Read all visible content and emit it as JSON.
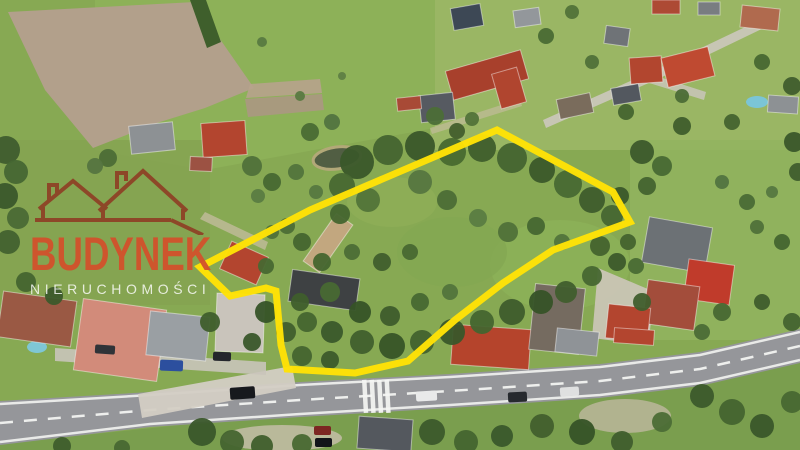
{
  "meta": {
    "type": "aerial-drone-photo",
    "width": 800,
    "height": 450,
    "description": "Aerial drone photo of a rural village property: an irregular wooded land parcel outlined in bright yellow, surrounded by houses, barns, fields, and a main road with a pedestrian crosswalk along the bottom. Real-estate agency watermark on the left."
  },
  "watermark": {
    "brand": "BUDYNEK",
    "subtitle": "NIERUCHOMOŚCI",
    "brand_color": "#d2512c",
    "subtitle_color": "#ffffff",
    "icon": "rooflines-icon",
    "icon_color": "#8f3722"
  },
  "parcel": {
    "outline_color": "#ffe206",
    "outline_width": 7,
    "outline_points": "497,130 613,192 630,222 553,250 503,283 455,320 408,361 355,373 287,369 281,345 276,291 266,288 230,296 200,267 310,210"
  },
  "scene": {
    "base": {
      "fill": "#87a953"
    },
    "regions": [
      {
        "name": "village-ground",
        "type": "rect",
        "x": 430,
        "y": 0,
        "w": 370,
        "h": 150,
        "fill": "#9cb766",
        "opacity": 0.9
      },
      {
        "name": "meadow-top",
        "type": "poly",
        "pts": "95,0 435,0 435,128 205,170 95,150",
        "fill": "#8db158",
        "opacity": 0.95
      },
      {
        "name": "lawn-left",
        "type": "rect",
        "x": 0,
        "y": 140,
        "w": 210,
        "h": 165,
        "fill": "#84a251",
        "opacity": 0.8
      },
      {
        "name": "plowed-field",
        "type": "poly",
        "pts": "8,12 195,2 222,42 254,88 205,108 160,122 93,148 45,90",
        "fill": "#b2a08b",
        "opacity": 1
      },
      {
        "name": "field-strip-1",
        "type": "poly",
        "pts": "245,99 322,94 324,110 248,117",
        "fill": "#ab9883",
        "opacity": 0.9
      },
      {
        "name": "field-strip-2",
        "type": "poly",
        "pts": "250,84 320,79 322,93 246,98",
        "fill": "#b7a38d",
        "opacity": 0.9
      },
      {
        "name": "right-field",
        "type": "rect",
        "x": 630,
        "y": 140,
        "w": 170,
        "h": 200,
        "fill": "#92b45f",
        "opacity": 0.85
      },
      {
        "name": "bottom-verge",
        "type": "poly",
        "pts": "0,444 800,360 800,450 0,450",
        "fill": "#7a9e4e",
        "opacity": 1
      },
      {
        "name": "parcel-grass-1",
        "type": "ellipse",
        "cx": 560,
        "cy": 265,
        "rx": 70,
        "ry": 45,
        "fill": "#8cb058",
        "opacity": 0.9
      },
      {
        "name": "parcel-grass-2",
        "type": "ellipse",
        "cx": 452,
        "cy": 252,
        "rx": 55,
        "ry": 35,
        "fill": "#84a852",
        "opacity": 0.85
      },
      {
        "name": "parcel-grass-3",
        "type": "ellipse",
        "cx": 392,
        "cy": 202,
        "rx": 45,
        "ry": 25,
        "fill": "#8fae57",
        "opacity": 0.8
      },
      {
        "name": "hedge-top",
        "type": "poly",
        "pts": "190,0 206,0 221,42 207,48",
        "fill": "#3f5f2c",
        "opacity": 1
      }
    ],
    "paths": [
      {
        "name": "driveway-apron",
        "type": "poly",
        "pts": "138,394 292,366 296,388 142,418",
        "fill": "#d3cec4",
        "opacity": 0.95
      },
      {
        "name": "side-street",
        "type": "poly",
        "pts": "55,348 266,362 266,375 55,361",
        "fill": "#c9c4ba",
        "opacity": 0.9
      },
      {
        "name": "gravel-yard",
        "type": "poly",
        "pts": "598,268 655,292 648,345 592,338",
        "fill": "#cdc6ba",
        "opacity": 0.9
      },
      {
        "name": "dirt-patch-1",
        "type": "ellipse",
        "cx": 282,
        "cy": 438,
        "rx": 60,
        "ry": 13,
        "fill": "#c9bfae",
        "opacity": 0.8
      },
      {
        "name": "dirt-patch-2",
        "type": "ellipse",
        "cx": 625,
        "cy": 416,
        "rx": 46,
        "ry": 17,
        "fill": "#c4b9a5",
        "opacity": 0.75
      },
      {
        "name": "village-street",
        "type": "poly",
        "pts": "543,120 655,70 764,18 770,25 660,78 546,128",
        "fill": "#ccc8bd",
        "opacity": 0.9
      },
      {
        "name": "village-street-spur",
        "type": "poly",
        "pts": "650,74 706,92 704,100 646,82",
        "fill": "#c9c5ba",
        "opacity": 0.85
      },
      {
        "name": "farm-track",
        "type": "poly",
        "pts": "430,128 520,99 522,106 432,134",
        "fill": "#c9bda4",
        "opacity": 0.6
      },
      {
        "name": "garden-path",
        "type": "poly",
        "pts": "205,212 268,242 265,250 200,219",
        "fill": "#cbbfa6",
        "opacity": 0.7
      }
    ],
    "pond": {
      "cx": 337,
      "cy": 158,
      "rx": 24,
      "ry": 11,
      "rot": -8,
      "fill": "#4f5a43",
      "stroke": "#b5a87b"
    },
    "pools": [
      {
        "cx": 37,
        "cy": 347,
        "rx": 10,
        "ry": 6,
        "fill": "#7ec8dc"
      },
      {
        "cx": 757,
        "cy": 102,
        "rx": 11,
        "ry": 6,
        "fill": "#79c6dc"
      }
    ],
    "road": {
      "surface": "0,401 150,392 300,382 450,374 600,364 700,352 800,329 800,363 700,386 600,398 450,408 300,417 150,427 0,445",
      "fill": "#95969a",
      "edge_top": "0,404 150,395 300,385 450,377 600,367 700,355 800,332",
      "edge_bottom": "0,442 150,424 300,414 450,405 600,395 700,383 800,360",
      "center": "0,423 150,410 300,400 450,391 600,381 700,369 800,346",
      "line_color": "#f2f3f1",
      "dash": "13 11"
    },
    "crosswalk": {
      "xs": [
        362,
        369.5,
        377,
        384.5
      ],
      "y": 380,
      "w": 4.5,
      "h": 33,
      "rot": -3,
      "fill": "#f4f5f3"
    },
    "buildings": [
      [
        130,
        124,
        44,
        28,
        -6,
        "#8d9194",
        "house-roof"
      ],
      [
        202,
        122,
        44,
        34,
        -4,
        "#b3452f",
        "house-roof-red"
      ],
      [
        190,
        157,
        22,
        14,
        3,
        "#9c5243",
        "shed-roof"
      ],
      [
        452,
        6,
        30,
        22,
        -10,
        "#3d4855",
        "house-roof-dark"
      ],
      [
        514,
        9,
        26,
        17,
        -8,
        "#93979b",
        "house-roof"
      ],
      [
        448,
        60,
        78,
        30,
        -16,
        "#a8402c",
        "barn-roof-red"
      ],
      [
        496,
        70,
        26,
        36,
        -16,
        "#b0452f",
        "barn-wing-roof"
      ],
      [
        420,
        94,
        34,
        27,
        -6,
        "#565a61",
        "house-roof-grey"
      ],
      [
        397,
        97,
        24,
        13,
        -6,
        "#a84a36",
        "shed-roof-red"
      ],
      [
        605,
        27,
        24,
        18,
        8,
        "#6f7377",
        "house-roof"
      ],
      [
        630,
        57,
        32,
        26,
        -4,
        "#b2462f",
        "house-roof-red"
      ],
      [
        664,
        52,
        48,
        30,
        -14,
        "#bf4a31",
        "warehouse-roof-red"
      ],
      [
        612,
        86,
        28,
        17,
        -10,
        "#53585f",
        "house-roof-dark"
      ],
      [
        558,
        96,
        34,
        20,
        -12,
        "#7a6c5c",
        "house-roof-brown"
      ],
      [
        652,
        0,
        28,
        14,
        0,
        "#ad4a34",
        "house-roof-red"
      ],
      [
        698,
        2,
        22,
        13,
        0,
        "#797d81",
        "house-roof"
      ],
      [
        741,
        7,
        38,
        22,
        6,
        "#b06a4e",
        "house-roof-tan"
      ],
      [
        768,
        96,
        30,
        17,
        4,
        "#8d9194",
        "house-roof"
      ],
      [
        645,
        222,
        64,
        46,
        10,
        "#6c7175",
        "inn-roof-grey"
      ],
      [
        686,
        262,
        46,
        40,
        8,
        "#c03b2b",
        "house-roof-red-hip"
      ],
      [
        645,
        283,
        52,
        44,
        8,
        "#a34d3b",
        "house-roof-brownred"
      ],
      [
        607,
        306,
        42,
        34,
        6,
        "#b3452f",
        "house-roof-red"
      ],
      [
        0,
        296,
        74,
        46,
        8,
        "#9a5944",
        "longhouse-roof-brown"
      ],
      [
        78,
        304,
        84,
        72,
        8,
        "#d28b7a",
        "warehouse-roof-pink"
      ],
      [
        148,
        314,
        60,
        44,
        6,
        "#9a9fa3",
        "house-roof-grey"
      ],
      [
        216,
        294,
        48,
        58,
        2,
        "#c9c4bb",
        "apartment-roof-white"
      ],
      [
        224,
        248,
        40,
        30,
        24,
        "#b3452f",
        "barn-roof-redtile"
      ],
      [
        318,
        214,
        20,
        58,
        35,
        "#c2a77f",
        "ruin-barn-roof-tan"
      ],
      [
        290,
        274,
        68,
        32,
        8,
        "#3e4143",
        "barn-roof-dark"
      ],
      [
        452,
        327,
        78,
        40,
        4,
        "#b5442c",
        "house-roof-red-hip"
      ],
      [
        532,
        286,
        50,
        66,
        6,
        "#756b60",
        "barn-roof-grey"
      ],
      [
        358,
        418,
        54,
        32,
        4,
        "#54585e",
        "building-roof-dark"
      ],
      [
        556,
        330,
        42,
        24,
        6,
        "#8f9397",
        "house-roof"
      ],
      [
        614,
        329,
        40,
        15,
        4,
        "#b3452f",
        "house-roof-red"
      ]
    ],
    "cars": [
      [
        416,
        391,
        21,
        10,
        -3,
        "#e9eaea"
      ],
      [
        508,
        392,
        19,
        10,
        -3,
        "#26292e"
      ],
      [
        560,
        387,
        19,
        9,
        -4,
        "#dfe0e0"
      ],
      [
        230,
        387,
        25,
        12,
        -4,
        "#17191d"
      ],
      [
        314,
        426,
        17,
        9,
        0,
        "#7c2622"
      ],
      [
        315,
        438,
        17,
        9,
        0,
        "#121419"
      ],
      [
        160,
        360,
        23,
        11,
        2,
        "#2c4f9e"
      ],
      [
        213,
        352,
        18,
        9,
        2,
        "#24272c"
      ],
      [
        95,
        345,
        20,
        9,
        4,
        "#303338"
      ]
    ],
    "trees": [
      [
        357,
        162,
        17,
        "#3a572a"
      ],
      [
        388,
        150,
        15,
        "#446430"
      ],
      [
        420,
        146,
        15,
        "#3a572a"
      ],
      [
        452,
        152,
        14,
        "#48692f"
      ],
      [
        482,
        148,
        14,
        "#3f5e2c"
      ],
      [
        512,
        158,
        15,
        "#456430"
      ],
      [
        542,
        170,
        13,
        "#3b582a"
      ],
      [
        568,
        184,
        14,
        "#486933"
      ],
      [
        592,
        200,
        13,
        "#3e5c2c"
      ],
      [
        612,
        216,
        11,
        "#466631"
      ],
      [
        342,
        186,
        13,
        "#486831"
      ],
      [
        368,
        200,
        12,
        "#527439"
      ],
      [
        340,
        214,
        10,
        "#44652f"
      ],
      [
        420,
        182,
        12,
        "#567640"
      ],
      [
        447,
        200,
        10,
        "#4c6d36"
      ],
      [
        600,
        246,
        10,
        "#44632e"
      ],
      [
        617,
        262,
        9,
        "#3c5a2b"
      ],
      [
        592,
        276,
        10,
        "#476731"
      ],
      [
        566,
        292,
        11,
        "#405e2d"
      ],
      [
        541,
        302,
        12,
        "#365327"
      ],
      [
        512,
        312,
        13,
        "#3e5c2c"
      ],
      [
        482,
        322,
        12,
        "#44652f"
      ],
      [
        452,
        332,
        13,
        "#3a572a"
      ],
      [
        422,
        342,
        12,
        "#42622e"
      ],
      [
        392,
        346,
        13,
        "#375427"
      ],
      [
        362,
        342,
        12,
        "#405f2d"
      ],
      [
        332,
        332,
        11,
        "#3a582b"
      ],
      [
        307,
        322,
        10,
        "#44652f"
      ],
      [
        300,
        302,
        9,
        "#3f5e2c"
      ],
      [
        330,
        292,
        10,
        "#486933"
      ],
      [
        360,
        312,
        11,
        "#365327"
      ],
      [
        390,
        316,
        10,
        "#3e5c2c"
      ],
      [
        420,
        302,
        9,
        "#476831"
      ],
      [
        450,
        292,
        8,
        "#52743c"
      ],
      [
        322,
        262,
        9,
        "#44652f"
      ],
      [
        352,
        252,
        8,
        "#4c6d36"
      ],
      [
        382,
        262,
        9,
        "#405e2d"
      ],
      [
        410,
        252,
        8,
        "#486831"
      ],
      [
        478,
        218,
        9,
        "#5a7c42"
      ],
      [
        508,
        232,
        10,
        "#507139"
      ],
      [
        536,
        226,
        9,
        "#466731"
      ],
      [
        562,
        242,
        8,
        "#52743c"
      ],
      [
        620,
        196,
        9,
        "#3a572a"
      ],
      [
        628,
        242,
        8,
        "#44632e"
      ],
      [
        252,
        166,
        10,
        "#50713a"
      ],
      [
        272,
        182,
        9,
        "#476832"
      ],
      [
        296,
        172,
        8,
        "#52743c"
      ],
      [
        258,
        196,
        7,
        "#5a7c42"
      ],
      [
        287,
        226,
        8,
        "#4c6d36"
      ],
      [
        302,
        242,
        9,
        "#44652f"
      ],
      [
        272,
        232,
        7,
        "#507139"
      ],
      [
        316,
        192,
        7,
        "#567840"
      ],
      [
        310,
        132,
        9,
        "#4a6b34"
      ],
      [
        332,
        122,
        8,
        "#527440"
      ],
      [
        210,
        322,
        10,
        "#3f5e2c"
      ],
      [
        266,
        312,
        11,
        "#365327"
      ],
      [
        286,
        332,
        10,
        "#405e2d"
      ],
      [
        252,
        342,
        9,
        "#3a572a"
      ],
      [
        302,
        356,
        10,
        "#44642f"
      ],
      [
        330,
        360,
        9,
        "#3c5a2b"
      ],
      [
        266,
        266,
        8,
        "#486831"
      ],
      [
        6,
        150,
        14,
        "#3f5d2e"
      ],
      [
        16,
        172,
        12,
        "#466733"
      ],
      [
        5,
        196,
        13,
        "#3a582b"
      ],
      [
        18,
        218,
        11,
        "#4a6a35"
      ],
      [
        8,
        242,
        12,
        "#42622f"
      ],
      [
        26,
        282,
        10,
        "#44652f"
      ],
      [
        54,
        296,
        9,
        "#3c5a2b"
      ],
      [
        300,
        96,
        5,
        "#5a7a42"
      ],
      [
        342,
        76,
        4,
        "#5f8045"
      ],
      [
        262,
        42,
        5,
        "#587a41"
      ],
      [
        435,
        116,
        9,
        "#4c6e37"
      ],
      [
        457,
        131,
        8,
        "#435f2d"
      ],
      [
        472,
        119,
        7,
        "#527339"
      ],
      [
        546,
        36,
        8,
        "#4a6b34"
      ],
      [
        592,
        62,
        7,
        "#507139"
      ],
      [
        626,
        112,
        8,
        "#44652f"
      ],
      [
        682,
        96,
        7,
        "#4c6d36"
      ],
      [
        762,
        62,
        8,
        "#486831"
      ],
      [
        792,
        86,
        9,
        "#405e2d"
      ],
      [
        732,
        122,
        8,
        "#44642f"
      ],
      [
        682,
        126,
        9,
        "#3f5e2c"
      ],
      [
        572,
        12,
        7,
        "#527339"
      ],
      [
        642,
        152,
        12,
        "#3c5a2b"
      ],
      [
        662,
        166,
        10,
        "#486933"
      ],
      [
        647,
        186,
        9,
        "#44642f"
      ],
      [
        636,
        266,
        8,
        "#4a6b34"
      ],
      [
        642,
        302,
        9,
        "#405e2d"
      ],
      [
        722,
        182,
        7,
        "#527440"
      ],
      [
        747,
        202,
        8,
        "#4a6b35"
      ],
      [
        772,
        192,
        6,
        "#567840"
      ],
      [
        757,
        227,
        7,
        "#507139"
      ],
      [
        782,
        242,
        8,
        "#44652f"
      ],
      [
        722,
        312,
        9,
        "#486831"
      ],
      [
        762,
        302,
        8,
        "#3f5d2c"
      ],
      [
        792,
        322,
        9,
        "#44642f"
      ],
      [
        702,
        332,
        8,
        "#4c6d36"
      ],
      [
        794,
        142,
        10,
        "#3a572a"
      ],
      [
        798,
        172,
        9,
        "#405e2d"
      ],
      [
        202,
        432,
        14,
        "#3a572a"
      ],
      [
        232,
        442,
        12,
        "#44642f"
      ],
      [
        262,
        446,
        11,
        "#3f5e2c"
      ],
      [
        302,
        444,
        10,
        "#486831"
      ],
      [
        432,
        432,
        13,
        "#3c5a2b"
      ],
      [
        466,
        442,
        12,
        "#44652f"
      ],
      [
        502,
        436,
        11,
        "#3a582b"
      ],
      [
        542,
        426,
        12,
        "#425f2d"
      ],
      [
        582,
        432,
        13,
        "#365327"
      ],
      [
        622,
        442,
        11,
        "#405e2d"
      ],
      [
        702,
        396,
        12,
        "#3c5a2b"
      ],
      [
        732,
        412,
        13,
        "#44642f"
      ],
      [
        762,
        426,
        12,
        "#3a572a"
      ],
      [
        792,
        402,
        11,
        "#486831"
      ],
      [
        662,
        422,
        10,
        "#4c6d36"
      ],
      [
        62,
        446,
        9,
        "#3f5e2c"
      ],
      [
        122,
        448,
        8,
        "#486831"
      ],
      [
        108,
        158,
        9,
        "#4c6d36"
      ],
      [
        95,
        166,
        8,
        "#557540"
      ]
    ]
  }
}
